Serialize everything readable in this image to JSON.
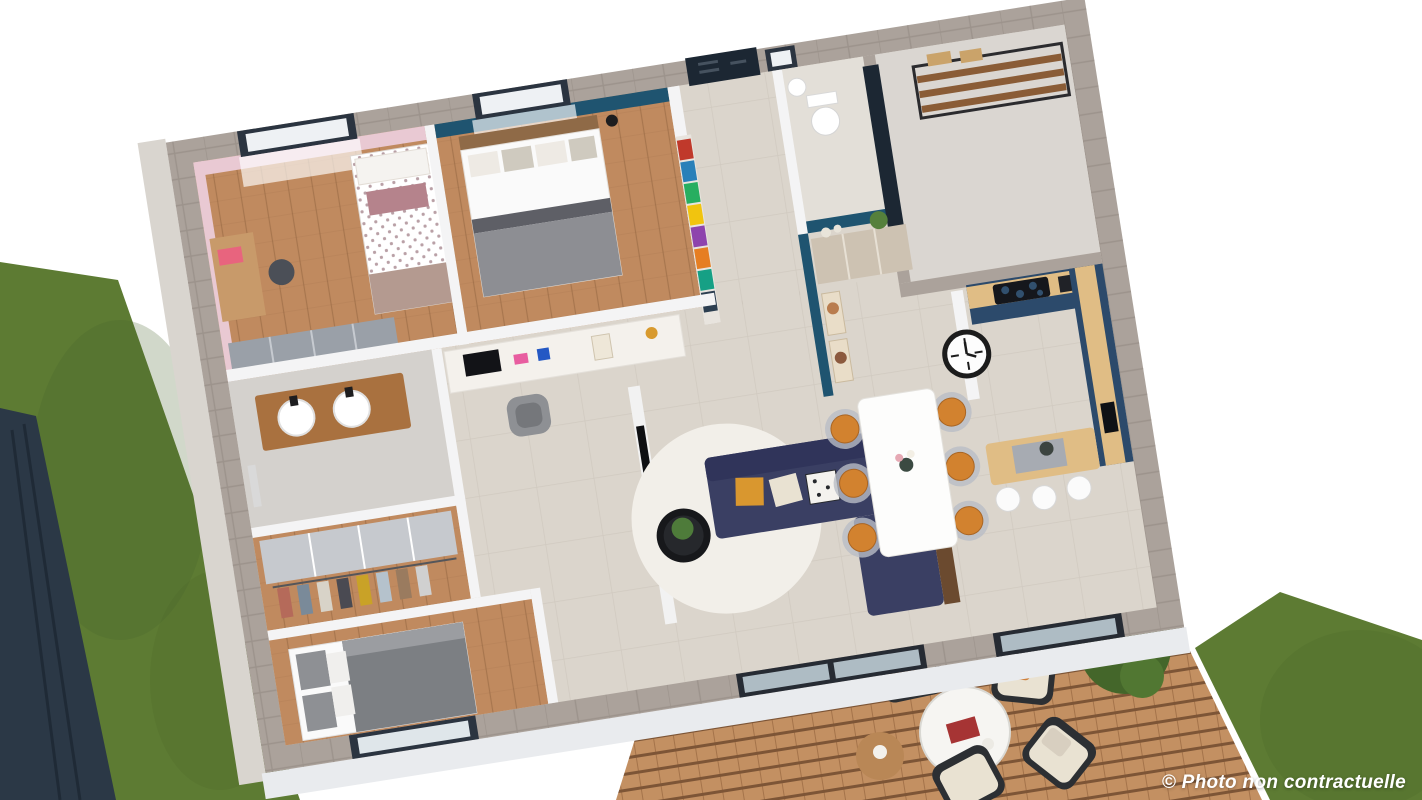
{
  "caption": {
    "text": "© Photo non contractuelle"
  },
  "palette": {
    "background": "#ffffff",
    "lawn": "#5d7b33",
    "lawn_dark": "#49622a",
    "fence": "#2b3846",
    "deck_wood": "#c39062",
    "deck_gap": "#7d5536",
    "stone_wall": "#aba29b",
    "ledge": "#e9ebee",
    "border_concrete": "#d9d5cf",
    "wall_white": "#f4f4f5",
    "floor_tile": "#dbd5cc",
    "floor_wood": "#c08a5f",
    "bath_tile": "#d4d1cd",
    "garage_floor": "#dad6d1",
    "pink_wall": "#e9c9d3",
    "teal_wall": "#1f5470",
    "navy_door": "#1c2733",
    "sofa_navy": "#3a3f63",
    "kitchen_navy": "#2c4a6b",
    "counter_wood": "#e0bd85",
    "vanity_wood": "#a9713f",
    "chair_orange": "#d2822f",
    "cushion_mustard": "#d9972f",
    "cushion_cream": "#e9e2d2",
    "blanket_gray": "#7c7f83",
    "rug_white": "#f2efe9",
    "clock_black": "#1c1c1c"
  }
}
